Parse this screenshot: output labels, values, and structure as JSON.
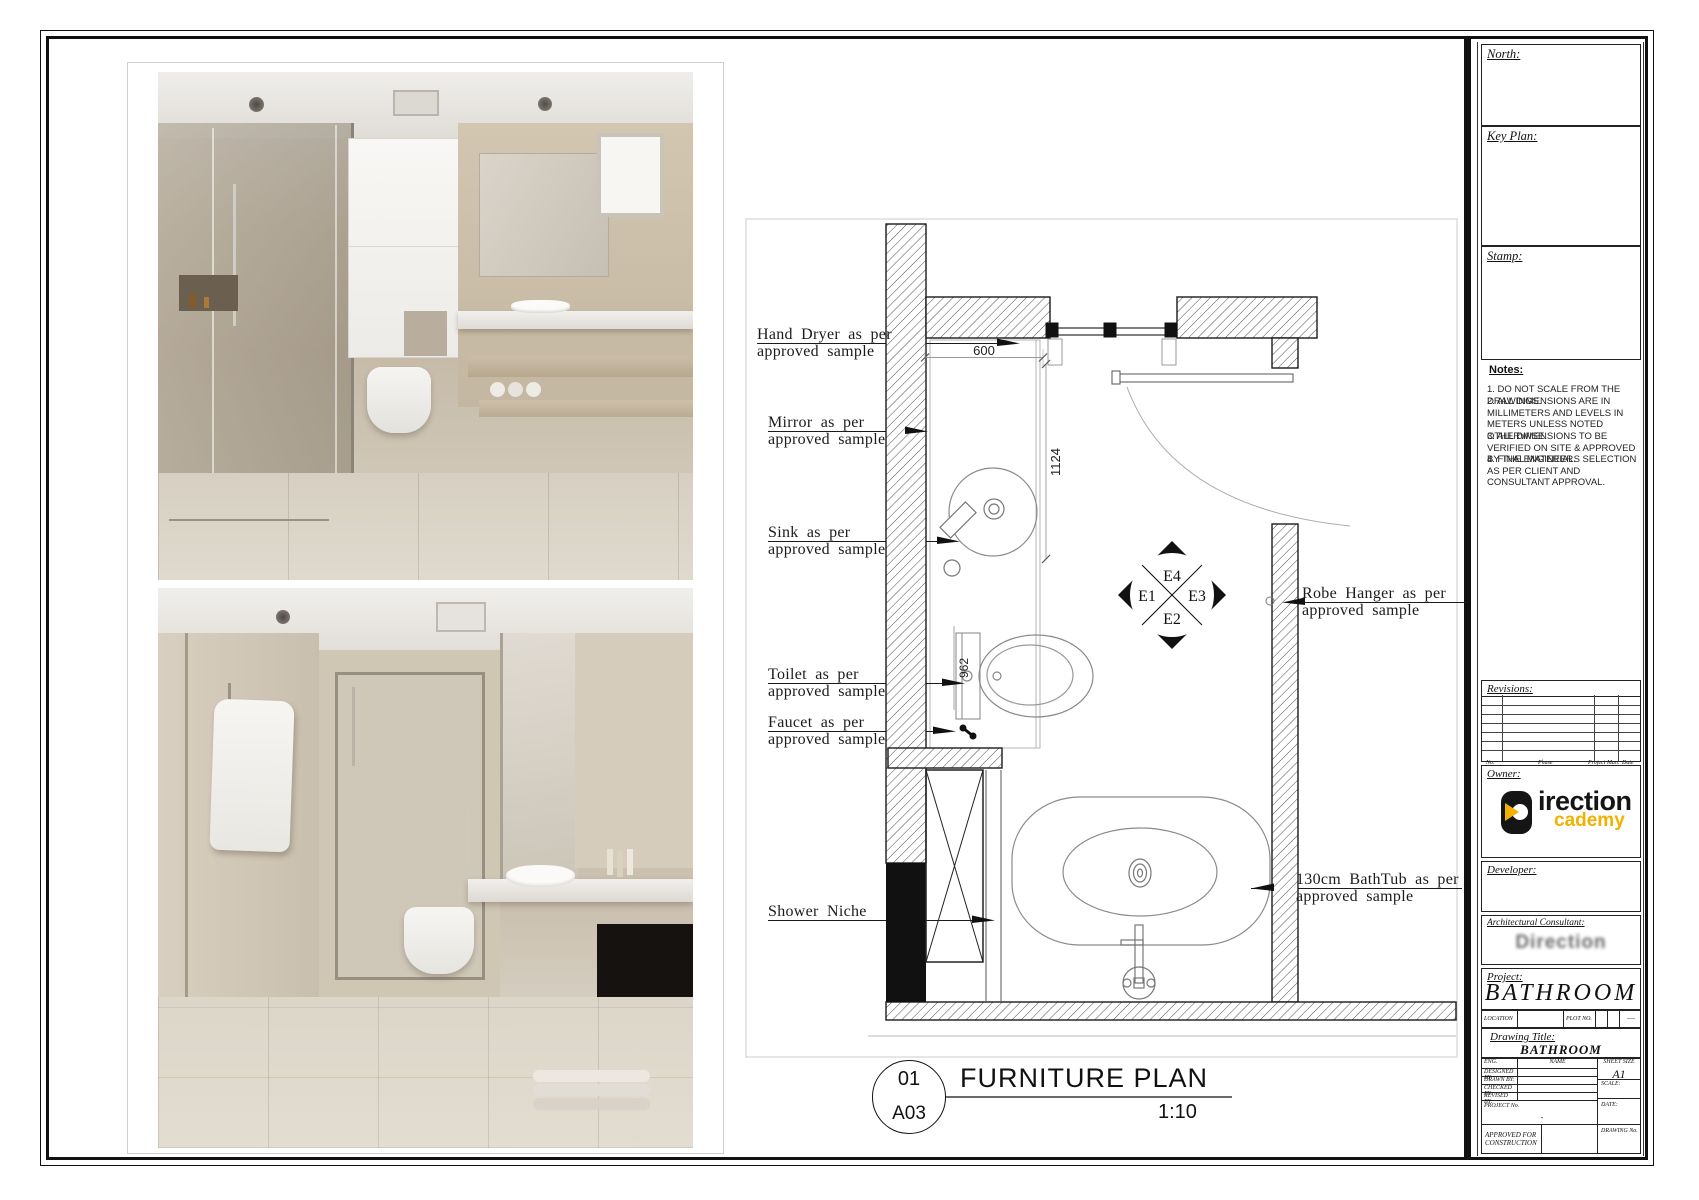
{
  "page": {
    "background": "#ffffff",
    "line_color": "#1b1b1b",
    "accent_yellow": "#f2b100"
  },
  "plan": {
    "callouts": [
      {
        "id": "hand-dryer",
        "line1": "Hand Dryer as per",
        "line2": "approved sample"
      },
      {
        "id": "mirror",
        "line1": "Mirror as per",
        "line2": "approved sample"
      },
      {
        "id": "sink",
        "line1": "Sink as per",
        "line2": "approved sample"
      },
      {
        "id": "toilet",
        "line1": "Toilet as per",
        "line2": "approved sample"
      },
      {
        "id": "faucet",
        "line1": "Faucet as per",
        "line2": "approved sample"
      },
      {
        "id": "shower-niche",
        "line1": "Shower Niche",
        "line2": ""
      },
      {
        "id": "robe-hanger",
        "line1": "Robe Hanger as per",
        "line2": "approved sample"
      },
      {
        "id": "bathtub",
        "line1": "130cm BathTub as per",
        "line2": "approved sample"
      }
    ],
    "dimensions": {
      "top": "600",
      "vertical": "1124",
      "toilet": "962"
    },
    "elevation_marker": {
      "top": "E4",
      "left": "E1",
      "right": "E3",
      "bottom": "E2"
    },
    "title": {
      "number": "01",
      "sheet": "A03",
      "name": "FURNITURE PLAN",
      "scale": "1:10"
    }
  },
  "sidebar": {
    "north_label": "North:",
    "key_plan_label": "Key Plan:",
    "stamp_label": "Stamp:",
    "notes": {
      "heading": "Notes:",
      "items": [
        "1. DO NOT SCALE FROM THE DRAWINGS.",
        "2. ALL DIMENSIONS ARE IN MILLIMETERS AND LEVELS IN METERS UNLESS NOTED OTHERWISE.",
        "3. ALL DIMENSIONS TO BE VERIFIED ON SITE & APPROVED BY THE ENGINEER.",
        "4. FINAL MATERIALS SELECTION AS PER CLIENT AND CONSULTANT APPROVAL."
      ]
    },
    "revisions": {
      "label": "Revisions:",
      "columns": [
        "No.",
        "Phase",
        "Project Man.",
        "Date"
      ]
    },
    "owner": {
      "label": "Owner:",
      "logo_line1": "irection",
      "logo_line2": "cademy"
    },
    "developer_label": "Developer:",
    "consultant": {
      "label": "Architectural Consultant:",
      "logo_text": "Direction"
    },
    "project": {
      "label": "Project:",
      "name": "BATHROOM"
    },
    "location_row": {
      "location_label": "LOCATION",
      "plot_label": "PLOT NO.",
      "dashes": "----"
    },
    "drawing_title": {
      "label": "Drawing Title:",
      "value": "BATHROOM"
    },
    "title_table": {
      "eng": "ENG.",
      "name": "NAME",
      "rows": [
        "DESIGNED BY:",
        "DRAWN BY:",
        "CHECKED BY:",
        "REVISED BY:"
      ],
      "sheet_size_label": "SHEET SIZE",
      "sheet_size_value": "A1",
      "scale_label": "SCALE:",
      "project_no_label": "PROJECT No.",
      "project_no_value": "-",
      "date_label": "DATE:",
      "drawing_no_label": "DRAWING No.",
      "approved": "APPROVED FOR CONSTRUCTION"
    }
  }
}
